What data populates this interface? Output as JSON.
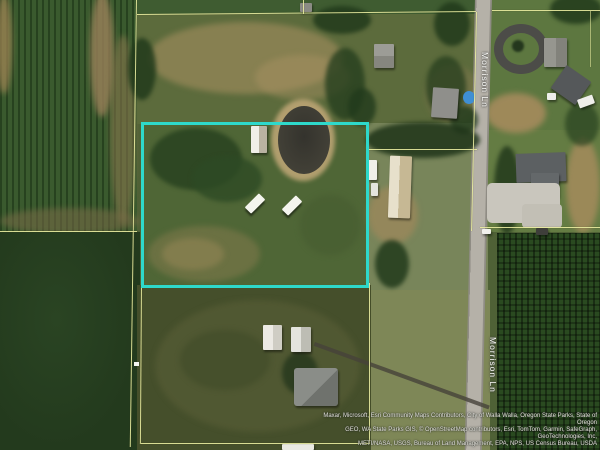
{
  "map": {
    "type": "satellite-parcel-view",
    "road_labels": [
      {
        "text": "Morrison Ln"
      },
      {
        "text": "Morrison Ln"
      }
    ],
    "attribution": {
      "lines": [
        "Maxar, Microsoft, Esri Community Maps Contributors, City of Walla Walla, Oregon State Parks, State of Oregon",
        "GEO, WA State Parks GIS, © OpenStreetMap contributors, Esri, TomTom, Garmin, SafeGraph, GeoTechnologies, Inc,",
        "METI/NASA, USGS, Bureau of Land Management, EPA, NPS, US Census Bureau, USDA"
      ]
    },
    "colors": {
      "parcel-line": "#e9eca0",
      "selected-parcel": "#2ed9cb",
      "road-fill": "#b5b1a8",
      "road-label": "#fafaf7",
      "attribution": "#e2e0da"
    }
  }
}
